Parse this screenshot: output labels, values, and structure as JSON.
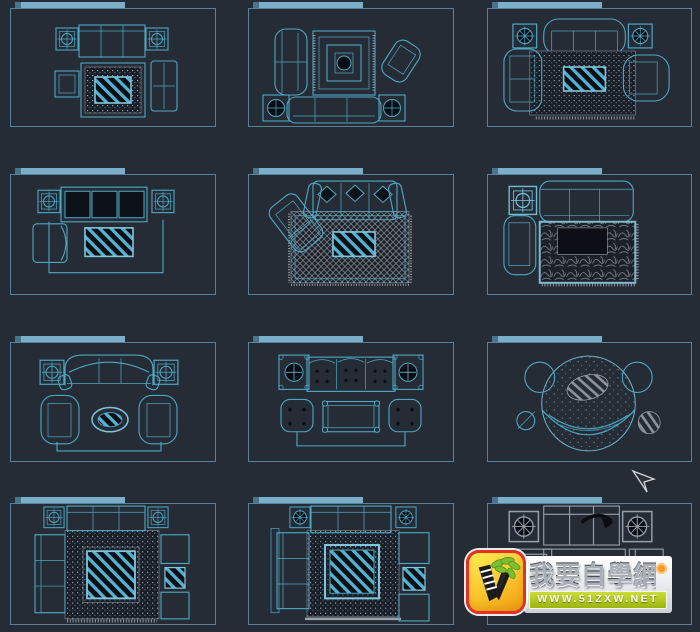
{
  "watermark": {
    "title": "我要自學網",
    "url": "WWW.51ZXW.NET"
  },
  "canvas": {
    "background": "#262c35",
    "panel_border": "#57839a",
    "titlebar_color": "#7aaec9",
    "line_color": "#4da8c5",
    "line_color_bright": "#7fc6dc",
    "line_color_gray": "#96a0ac",
    "rug_speckle_color": "#98a0a9",
    "glass_hatch_color": "#55b2d0",
    "dark_fill": "#0a0e14"
  },
  "logo_colors": {
    "frame_red": "#e23127",
    "icon_yellow": "#f7b31f",
    "leaf_green": "#7cbf31",
    "band_green": "#a9c21d",
    "badge_orange": "#f59a23"
  },
  "cells": [
    {
      "id": 1,
      "block": "sofa-set-square-rug-glass-table"
    },
    {
      "id": 2,
      "block": "sofa-set-layered-square-rug"
    },
    {
      "id": 3,
      "block": "curved-sofa-set-dotted-rug"
    },
    {
      "id": 4,
      "block": "three-seat-sofa-armchair-glass-table"
    },
    {
      "id": 5,
      "block": "sofa-with-chaise-crosshatch-rug"
    },
    {
      "id": 6,
      "block": "sofa-armchair-ornate-rug"
    },
    {
      "id": 7,
      "block": "curved-sofa-two-armchairs-oval-table"
    },
    {
      "id": 8,
      "block": "tufted-sofa-ottomans-coffee-table"
    },
    {
      "id": 9,
      "block": "round-rug-crescent-sofa-set"
    },
    {
      "id": 10,
      "block": "square-dotted-rug-sofa-set"
    },
    {
      "id": 11,
      "block": "square-dotted-rug-sofa-set-variant"
    },
    {
      "id": 12,
      "block": "sofa-set-under-watermark"
    }
  ]
}
